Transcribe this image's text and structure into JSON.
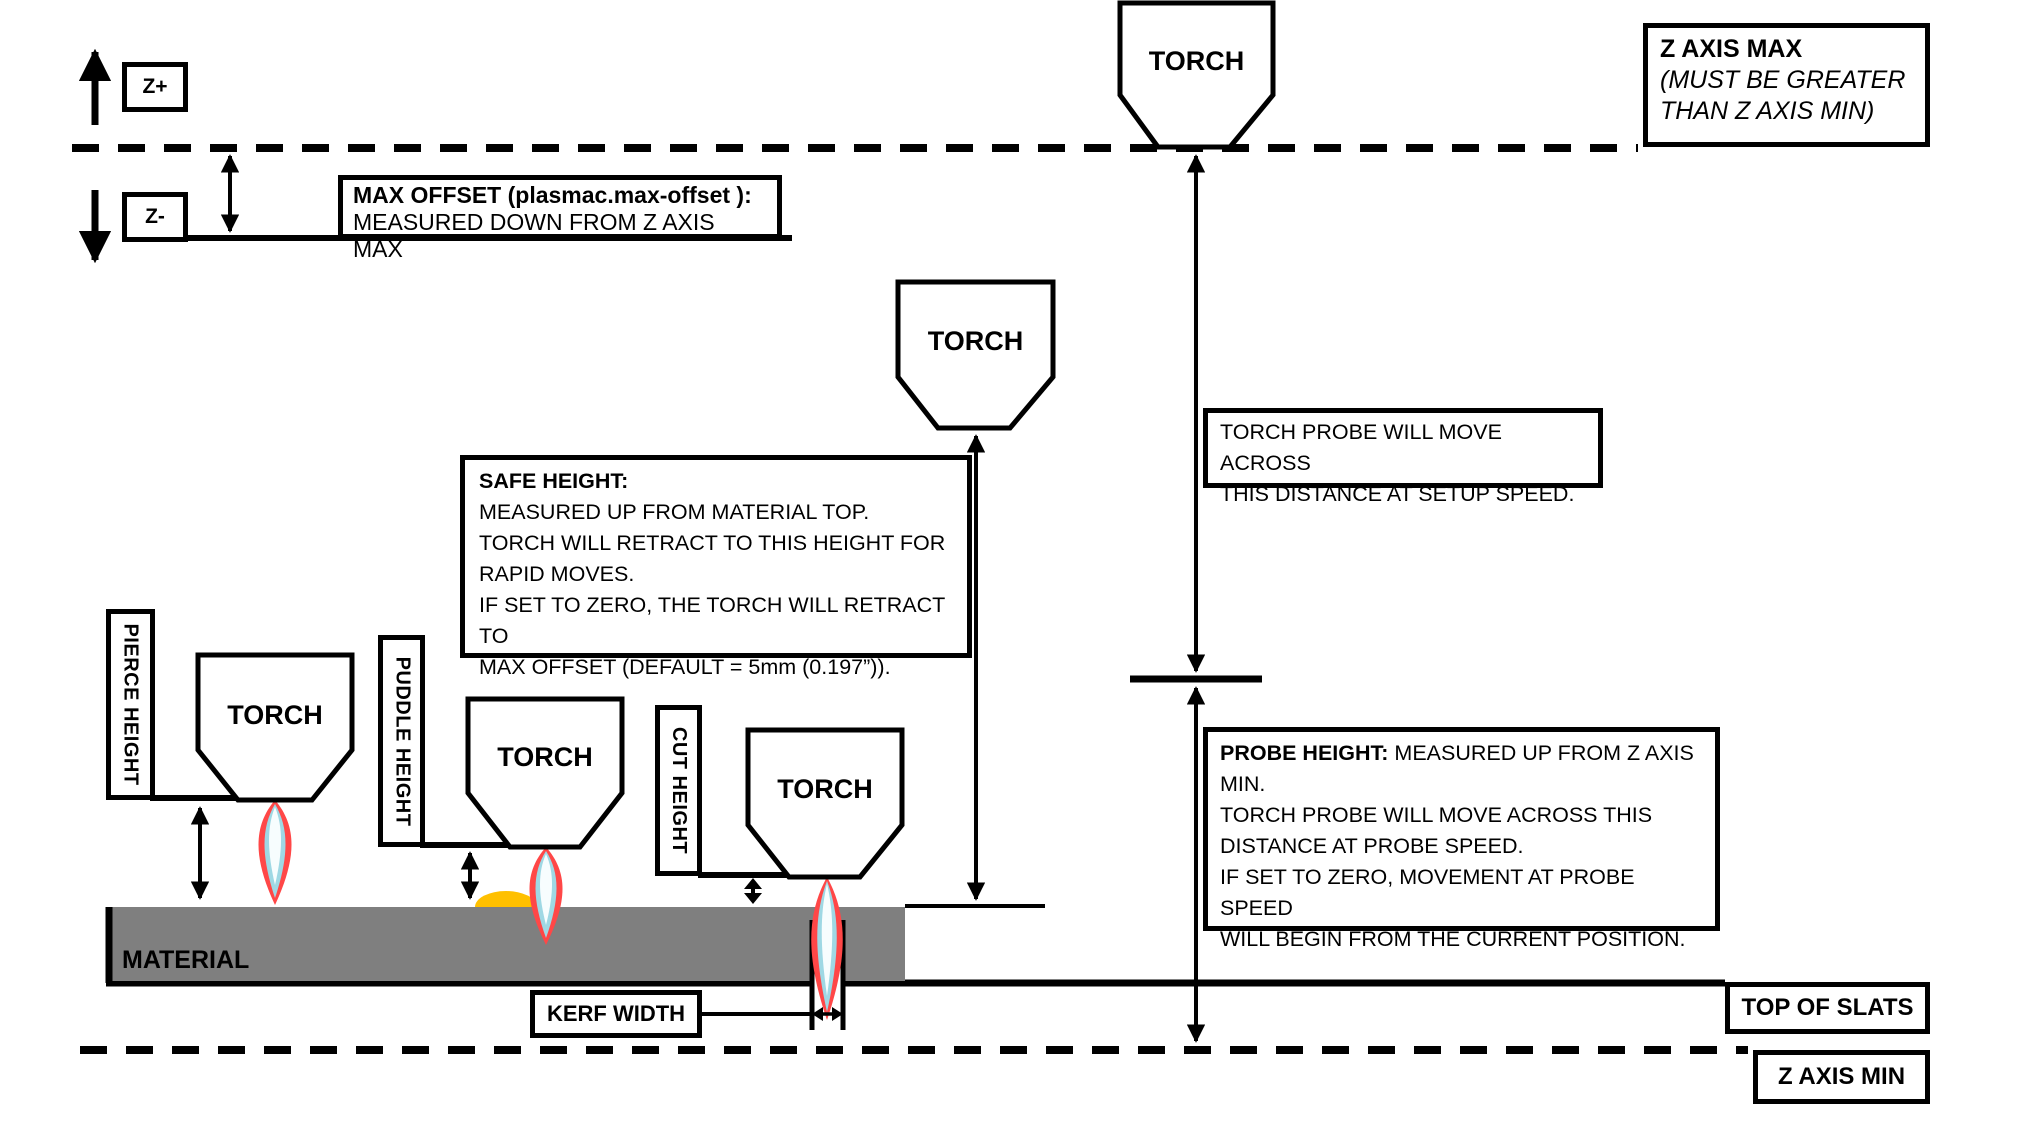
{
  "diagram": {
    "z_plus_label": "Z+",
    "z_minus_label": "Z-",
    "torch_label": "TORCH",
    "max_offset_box": {
      "title": "MAX OFFSET (plasmac.max-offset ):",
      "body": "MEASURED DOWN FROM Z AXIS MAX"
    },
    "z_axis_max_box": {
      "title": "Z AXIS MAX",
      "subtitle": "(MUST BE GREATER\nTHAN Z AXIS MIN)"
    },
    "torch_probe_box": {
      "body": "TORCH PROBE WILL MOVE ACROSS\nTHIS DISTANCE AT SETUP SPEED."
    },
    "safe_height_box": {
      "title": "SAFE HEIGHT:",
      "body": "MEASURED UP FROM MATERIAL TOP.\nTORCH WILL RETRACT TO THIS HEIGHT FOR\nRAPID MOVES.\nIF SET TO ZERO, THE TORCH WILL RETRACT TO\nMAX OFFSET (DEFAULT = 5mm (0.197”))."
    },
    "probe_height_box": {
      "title": "PROBE HEIGHT:",
      "body": " MEASURED UP FROM Z AXIS\nMIN.\nTORCH PROBE WILL MOVE ACROSS THIS\nDISTANCE AT PROBE SPEED.\nIF SET TO ZERO,  MOVEMENT AT PROBE SPEED\nWILL BEGIN FROM THE CURRENT POSITION."
    },
    "pierce_height_label": "PIERCE HEIGHT",
    "puddle_height_label": "PUDDLE HEIGHT",
    "cut_height_label": "CUT HEIGHT",
    "material_label": "MATERIAL",
    "kerf_width_label": "KERF WIDTH",
    "top_of_slats_label": "TOP OF SLATS",
    "z_axis_min_label": "Z AXIS MIN",
    "colors": {
      "material": "#7F7F7F",
      "puddle": "#FFC000",
      "flame_outer": "#FF4747",
      "flame_mid": "#9FD8E4",
      "flame_core": "#F7FDFE"
    }
  }
}
